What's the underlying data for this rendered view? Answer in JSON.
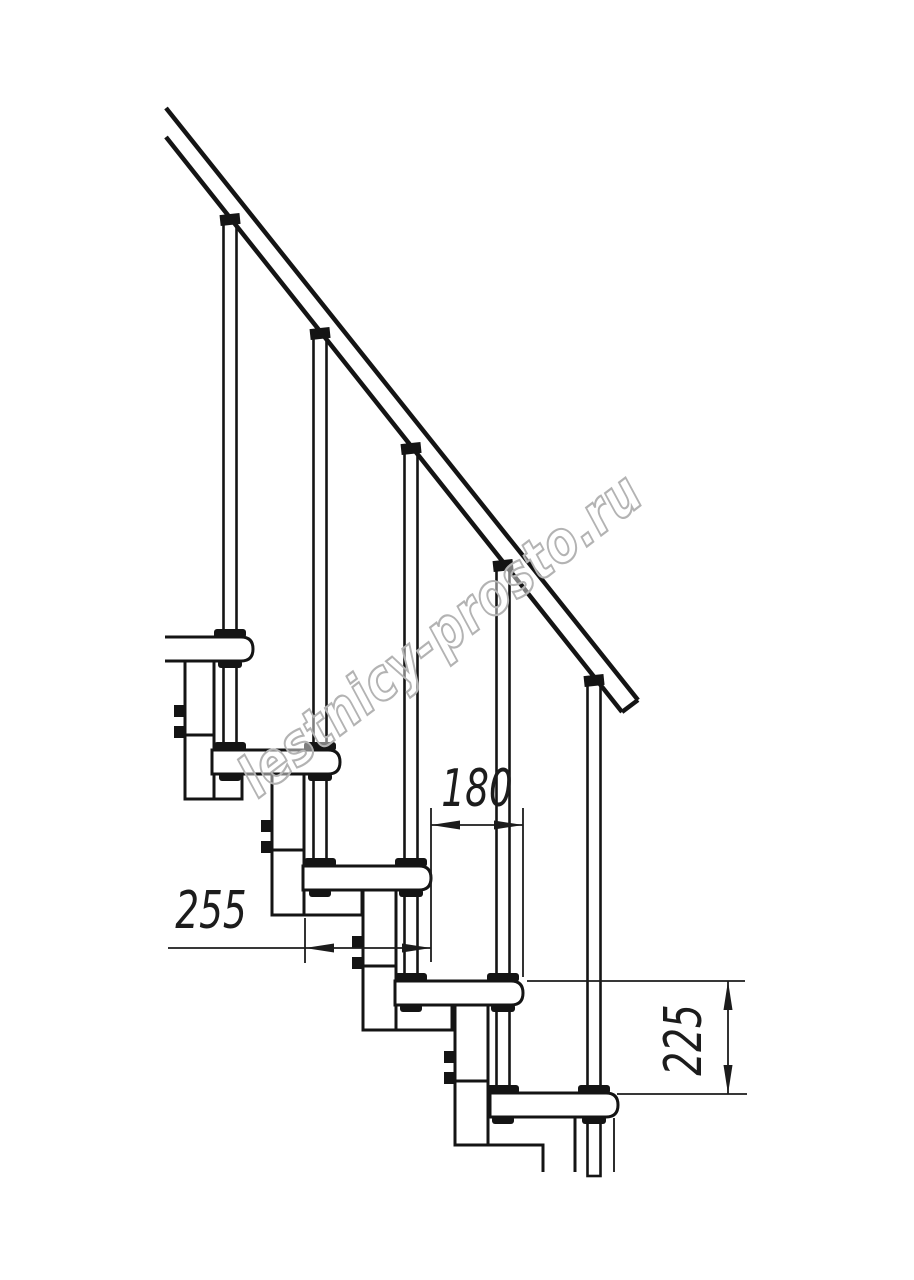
{
  "drawing": {
    "type": "staircase-side-elevation",
    "background_color": "#ffffff",
    "line_color": "#141414",
    "dim_color": "#1c1c1c",
    "watermark": {
      "text": "lestnicy-prosto.ru",
      "color": "#b3b3b3"
    },
    "dimensions": {
      "run": {
        "value": "180",
        "orientation": "horizontal"
      },
      "depth": {
        "value": "255",
        "orientation": "horizontal"
      },
      "rise": {
        "value": "225",
        "orientation": "vertical"
      }
    },
    "components": {
      "treads": 5,
      "balusters": 5,
      "handrail": 1
    }
  }
}
